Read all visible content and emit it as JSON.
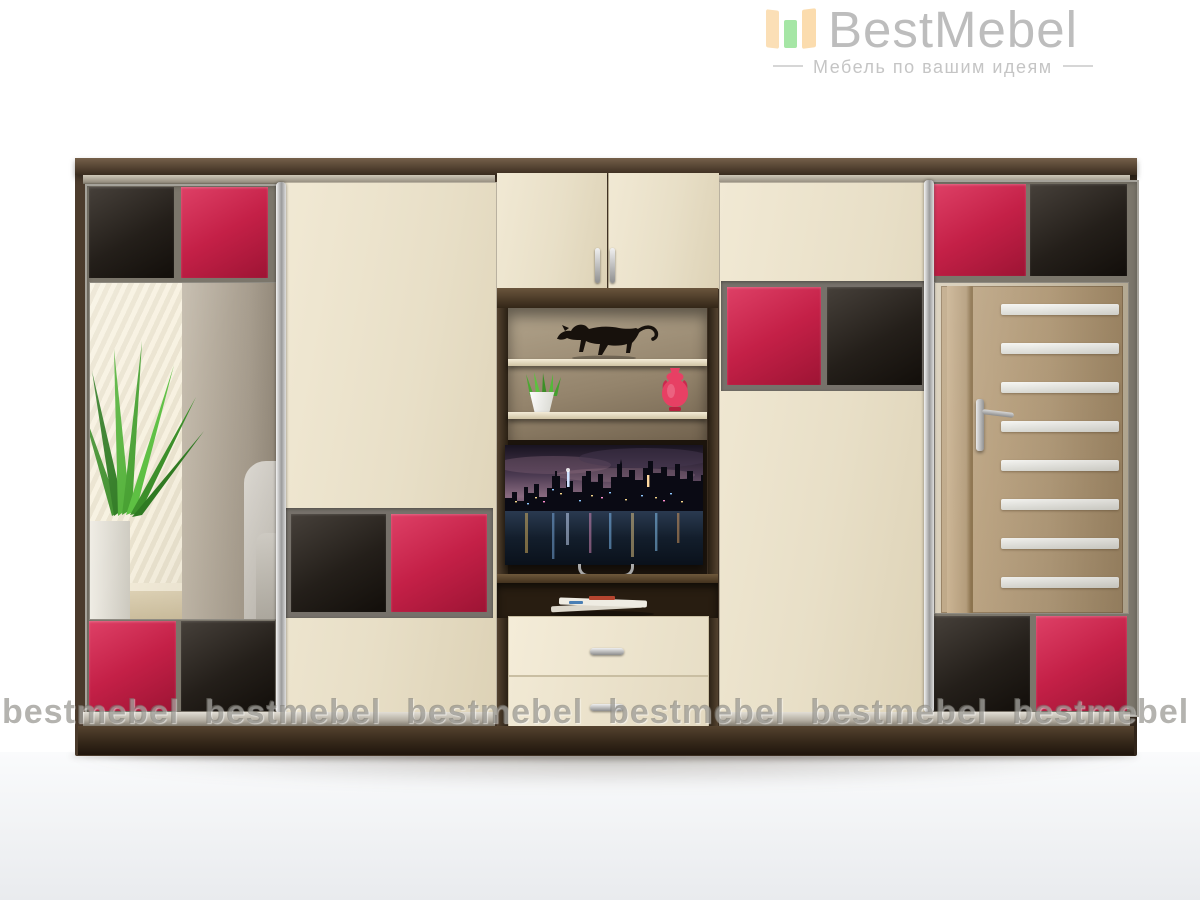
{
  "brand": {
    "name": "BestMebel",
    "tagline": "Мебель по вашим идеям"
  },
  "watermark": {
    "text": "bestmebel"
  },
  "palette": {
    "accent_red": "#c42047",
    "gloss_black": "#241f1a",
    "cream_panel": "#e8dfc7",
    "wenge_brown": "#3c2f23",
    "chrome": "#c7c7c7",
    "divider_gray": "#7b766b",
    "logo_text_gray": "#bdbdbd",
    "logo_bar_peach": "#fbdfb6",
    "logo_bar_green": "#a5e6a5",
    "watermark_gray": "#76746e"
  },
  "decor": {
    "figurine": "black panther figurine",
    "plant": "green grass plant in white pot",
    "vase": "red amphora vase",
    "tv": "TV showing night city skyline",
    "magazines": "magazines on TV stand shelf",
    "left_mirror_reflection": "room with plant and armchair",
    "right_mirror_reflection": "wooden interior door"
  }
}
